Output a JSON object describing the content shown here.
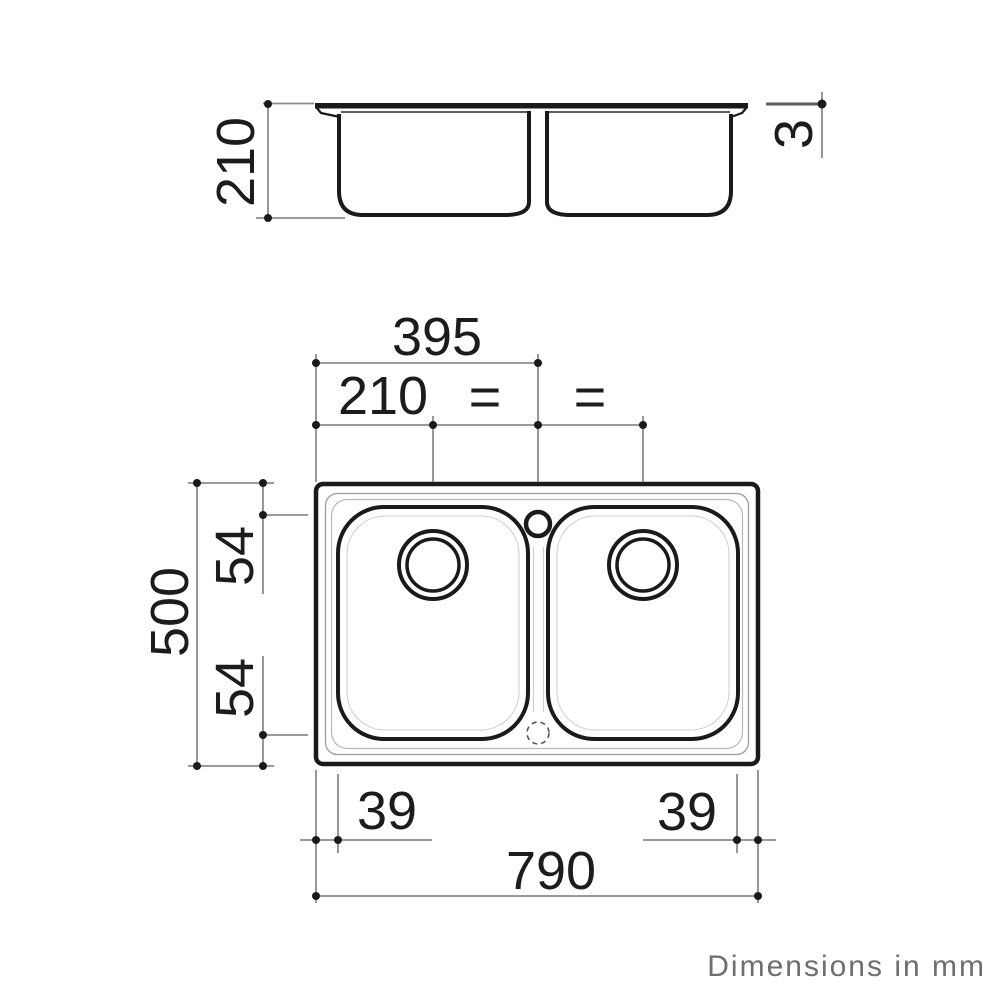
{
  "footer": {
    "note": "Dimensions in mm"
  },
  "colors": {
    "line": "#1a1a1a",
    "dimension_line": "#8c8c8c",
    "label_text": "#1c1c1c",
    "footer_text": "#6e6e6e",
    "background": "#ffffff"
  },
  "elevation_view": {
    "description": "side elevation of double-bowl sink",
    "labels": {
      "bowl_depth": "210",
      "rim_height": "3"
    }
  },
  "plan_view": {
    "description": "top plan of double-bowl sink with tap hole and two drains",
    "labels": {
      "center_span": "395",
      "drain_offset": "210",
      "equal_spacing_left": "=",
      "equal_spacing_right": "=",
      "overall_depth": "500",
      "top_inset": "54",
      "bottom_inset": "54",
      "corner_left": "39",
      "corner_right": "39",
      "overall_width": "790"
    }
  },
  "dimensions_mm": {
    "overall_width": 790,
    "overall_depth": 500,
    "bowl_depth": 210,
    "rim_height": 3,
    "center_span": 395,
    "drain_offset": 210,
    "edge_inset": 54,
    "corner_dim": 39
  }
}
